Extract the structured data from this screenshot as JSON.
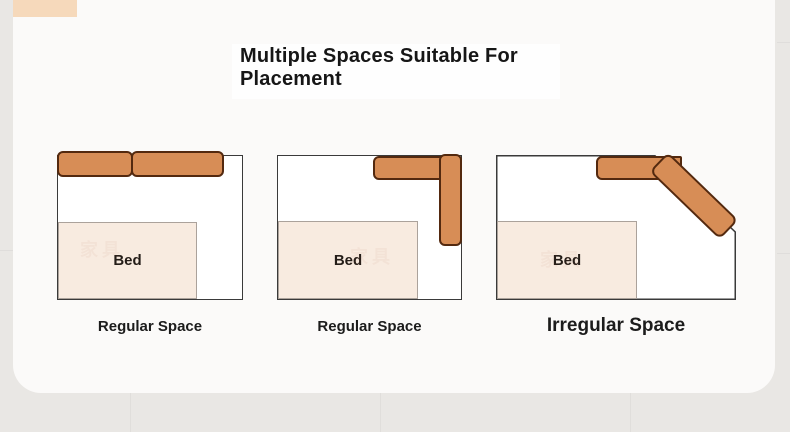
{
  "header": {
    "title_line1": "Multiple Spaces Suitable For",
    "title_line2": "Placement"
  },
  "diagrams": [
    {
      "caption": "Regular Space",
      "bed_label": "Bed"
    },
    {
      "caption": "Regular Space",
      "bed_label": "Bed"
    },
    {
      "caption": "Irregular Space",
      "bed_label": "Bed"
    }
  ],
  "watermark_text": "家具",
  "colors": {
    "sofa_fill": "#d78d56",
    "sofa_border": "#53290f",
    "bed_fill": "#f8ebe0",
    "bed_border": "#aba29b",
    "room_border": "#3a3a3a",
    "card_bg": "#fbfaf9",
    "outer_bg": "#e9e7e4",
    "accent_square": "#f6d9bb"
  }
}
